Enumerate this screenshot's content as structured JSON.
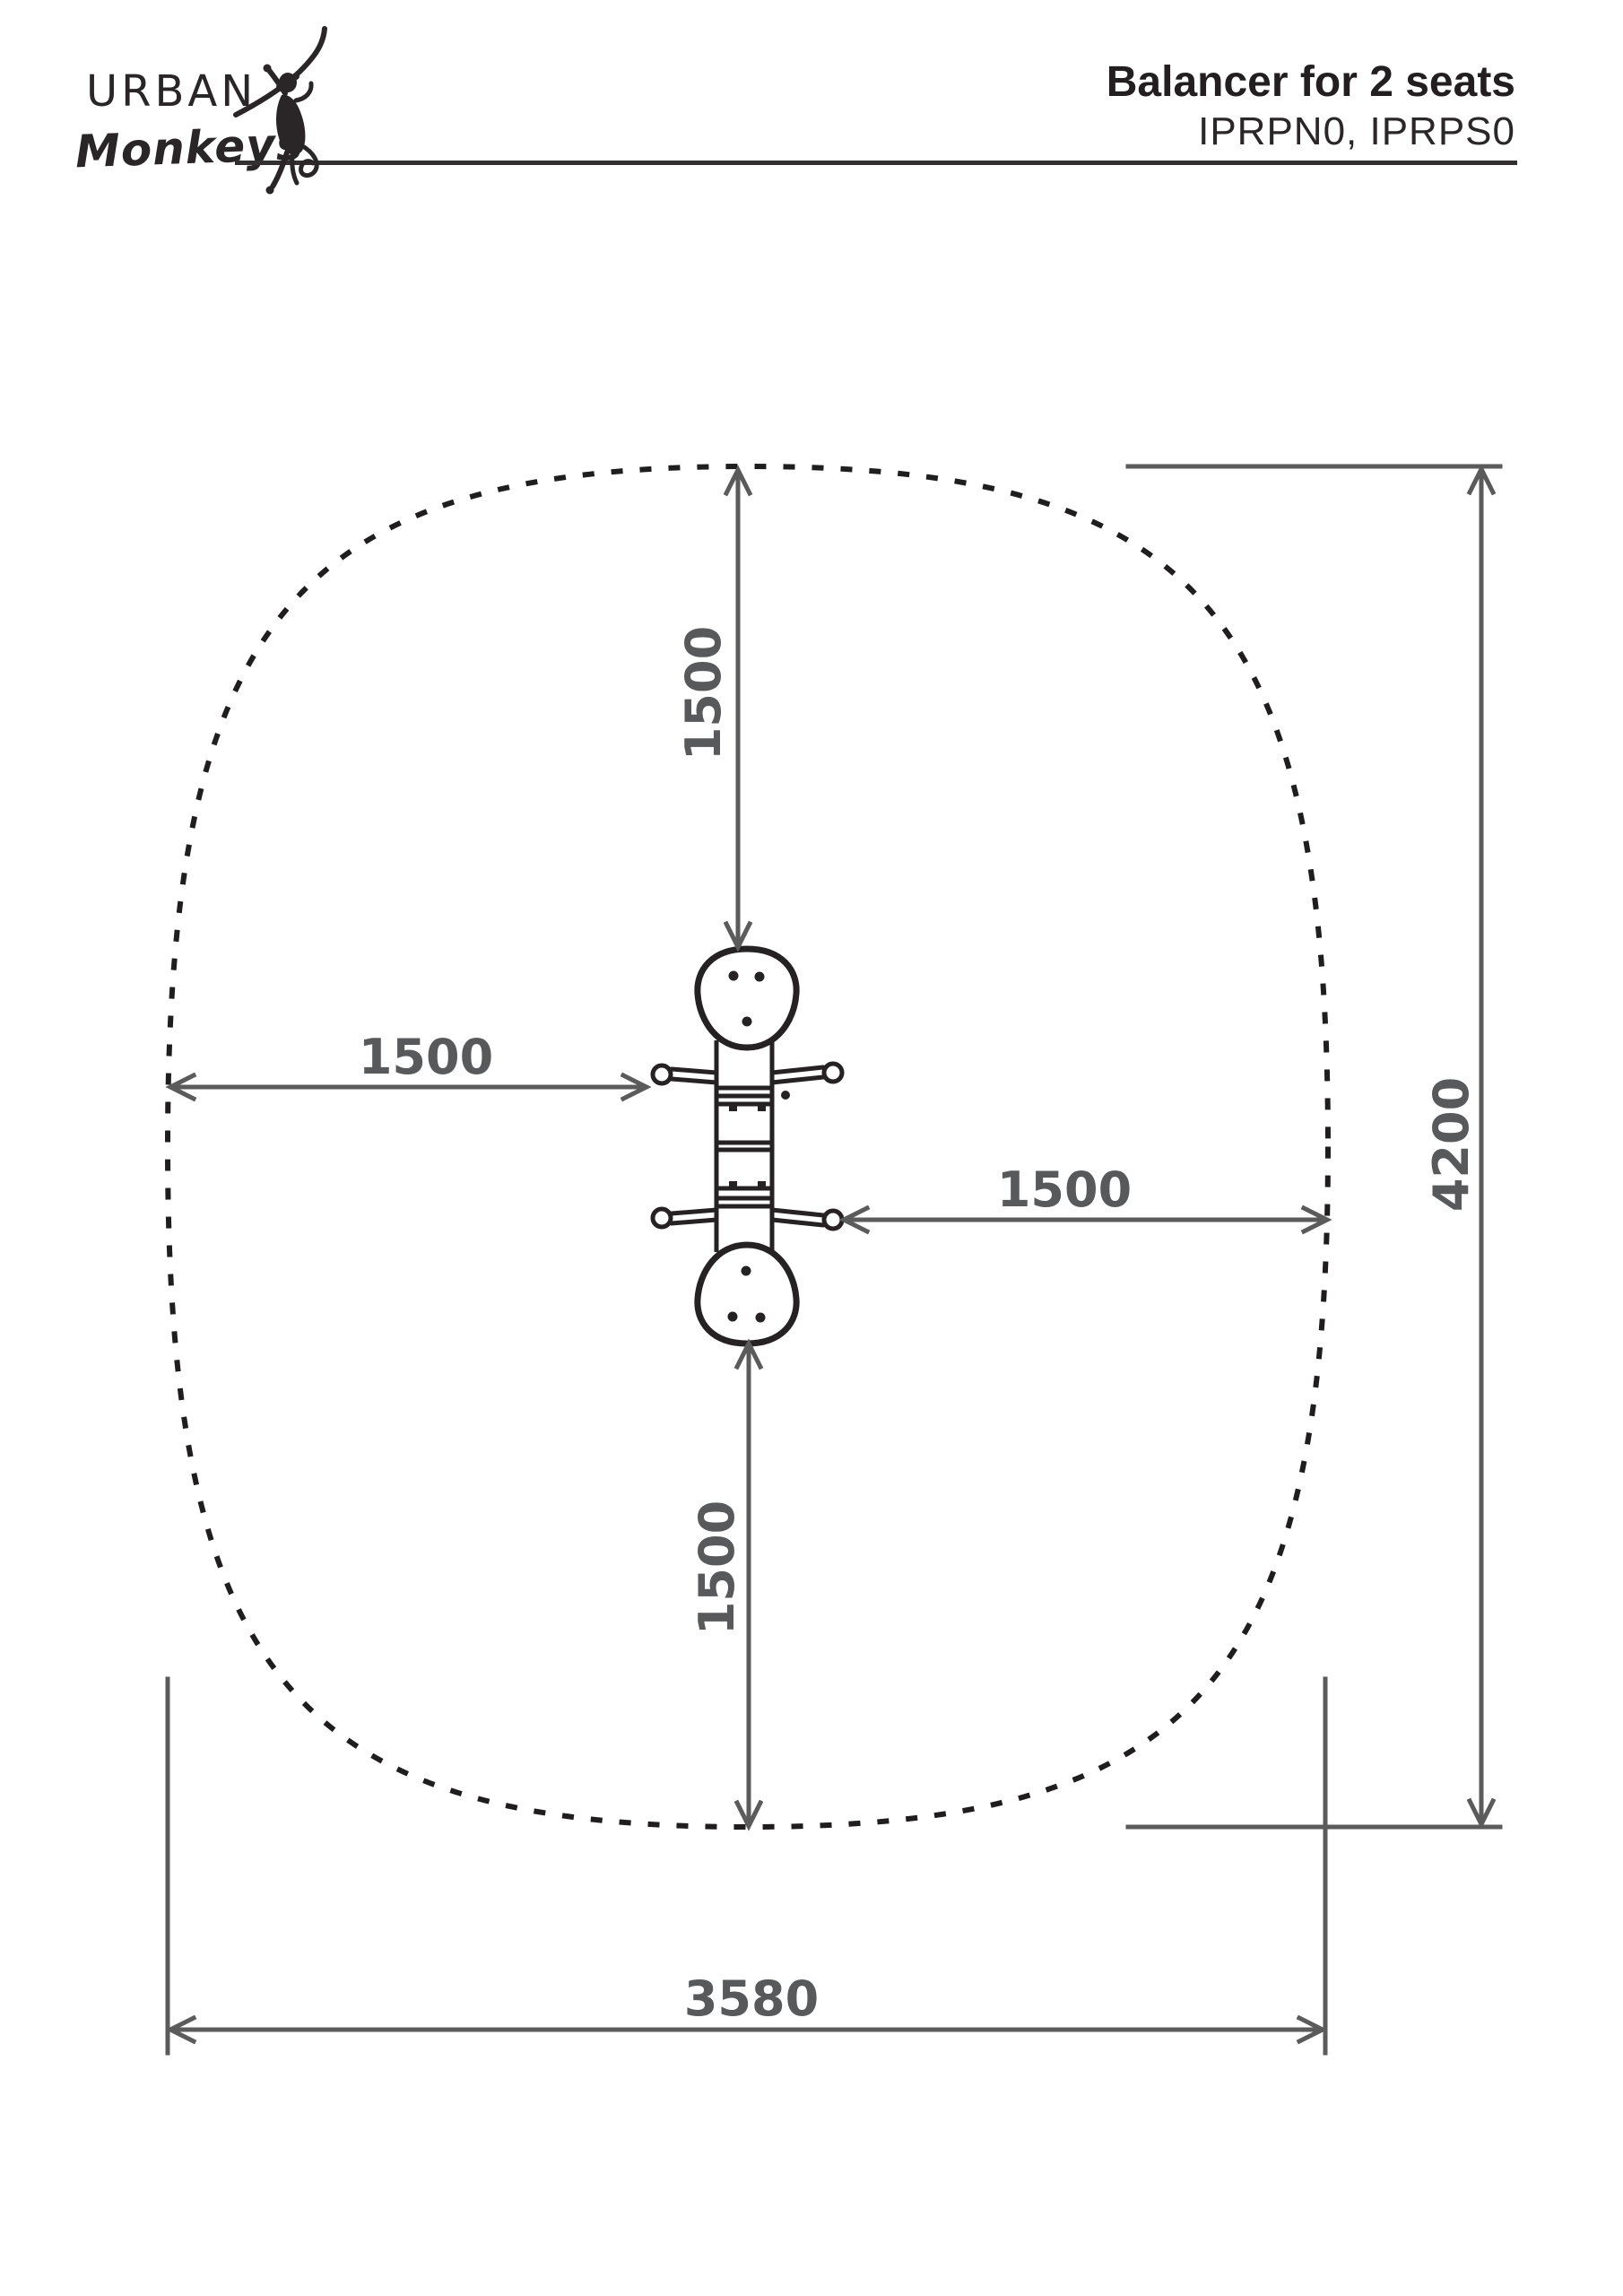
{
  "page": {
    "background": "#ffffff"
  },
  "header": {
    "logo_line1": "URBAN",
    "logo_line2": "Monkeys",
    "logo_icon": "hanging-monkey-on-branch",
    "title": "Balancer for 2 seats",
    "product_codes": "IPRPN0, IPRPS0"
  },
  "diagram": {
    "view": "top-view safety-zone plan of a 2-seat balancer",
    "boundary_style": "dotted",
    "colors": {
      "equipment_outline": "#262223",
      "boundary_black": "#1f1d1e",
      "dimension_gray": "#58595b"
    },
    "dimensions": {
      "top_clearance_mm": "1500",
      "left_clearance_mm": "1500",
      "right_clearance_mm": "1500",
      "bottom_clearance_mm": "1500",
      "zone_length_mm": "4200",
      "zone_width_mm": "3580"
    }
  }
}
